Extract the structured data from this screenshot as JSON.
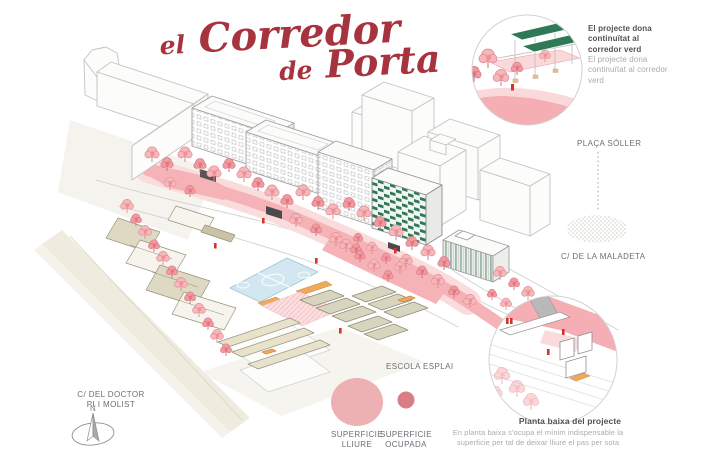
{
  "title": {
    "prefix": "el",
    "main": "Corredor",
    "line2_prefix": "de",
    "line2_main": "Porta"
  },
  "insets": {
    "top_right": {
      "caption_primary": "El projecte dona continuïtat al corredor verd",
      "caption_secondary": "El projecte dona continuïtat al corredor verd"
    },
    "bottom_right": {
      "caption_title": "Planta baixa del projecte",
      "caption_body": "En planta baixa s'ocupa el mínim indispensable la superficie per tal de deixar lliure el pas per sota"
    }
  },
  "street_labels": {
    "placa_soller": "PLAÇA SÓLLER",
    "carrer_maladeta": "C/ DE LA MALADETA",
    "carrer_doctor": "C/ DEL DOCTOR PI I MOLIST",
    "escola_esplai": "ESCOLA ESPLAI"
  },
  "legend": {
    "free_surface": {
      "label": "SUPERFICIE LLIURE",
      "color": "#edb0b3"
    },
    "occupied_surface": {
      "label": "SUPERFICIE OCUPADA",
      "color": "#d97e84"
    }
  },
  "compass": {
    "north_label": "N"
  },
  "colors": {
    "title_red": "#a6333e",
    "tree_pink": "#f5b7ba",
    "corridor_pink": "#f5b3b7",
    "green_facade": "#2e7a56",
    "court_blue": "#d3e7f1",
    "accent_orange": "#efa95c"
  }
}
